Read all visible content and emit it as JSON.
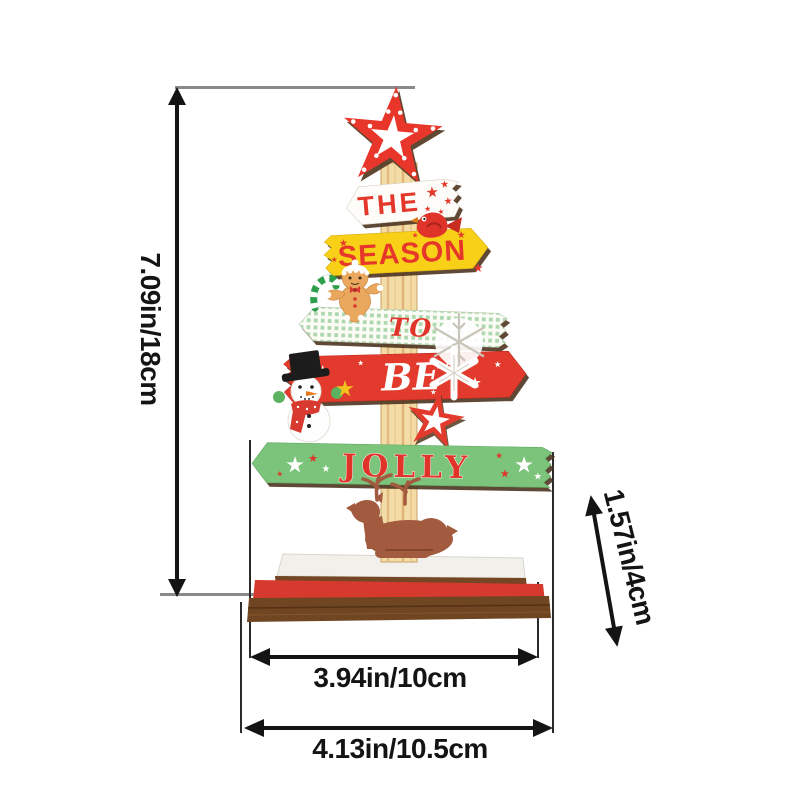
{
  "signs": [
    {
      "label": "THE"
    },
    {
      "label": "SEASON"
    },
    {
      "label": "TO"
    },
    {
      "label": "BE"
    },
    {
      "label": "JOLLY"
    }
  ],
  "dimensions": {
    "height": "7.09in/18cm",
    "depth": "1.57in/4cm",
    "board_width": "3.94in/10cm",
    "base_width": "4.13in/10.5cm"
  },
  "colors": {
    "sign_red": "#e5382b",
    "sign_yellow": "#f8d017",
    "sign_green": "#7cc47b",
    "sign_white": "#fdfcf8",
    "wood_post": "#f4dca6",
    "base_red": "#d63a2e",
    "base_brown": "#6f4522",
    "dimension_line": "#141414"
  }
}
